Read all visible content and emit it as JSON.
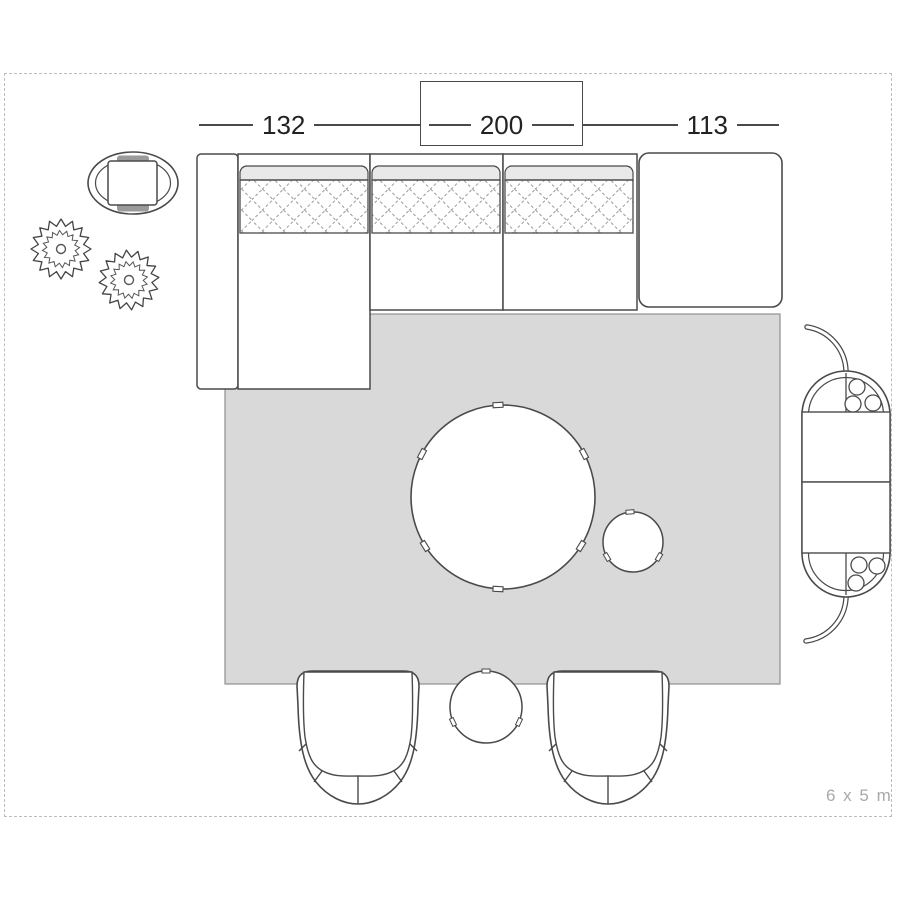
{
  "plan": {
    "dimension_labels": [
      {
        "name": "chaise-section-width",
        "value": "132"
      },
      {
        "name": "sofa-section-width",
        "value": "200"
      },
      {
        "name": "ottoman-section-width",
        "value": "113"
      }
    ],
    "room_size_label": "6 x 5 m",
    "furniture": [
      "sectional-sofa",
      "sofa-armrest",
      "sofa-chaise",
      "sofa-seat",
      "sofa-back-cushion",
      "ottoman",
      "rug",
      "coffee-table",
      "side-stool",
      "bar-cart",
      "armchair-left",
      "armchair-right",
      "side-table",
      "plant",
      "plant",
      "oval-side-table"
    ],
    "colors": {
      "rug_fill": "#d9d9d9",
      "outline": "#4a4a4a",
      "frame_dash": "#bdbdbd",
      "dimension_text": "#222222",
      "room_size_text": "#a9a9a9",
      "cushion_band_fill": "#e9e9e9",
      "quilt_line": "#9a9a9a"
    }
  }
}
